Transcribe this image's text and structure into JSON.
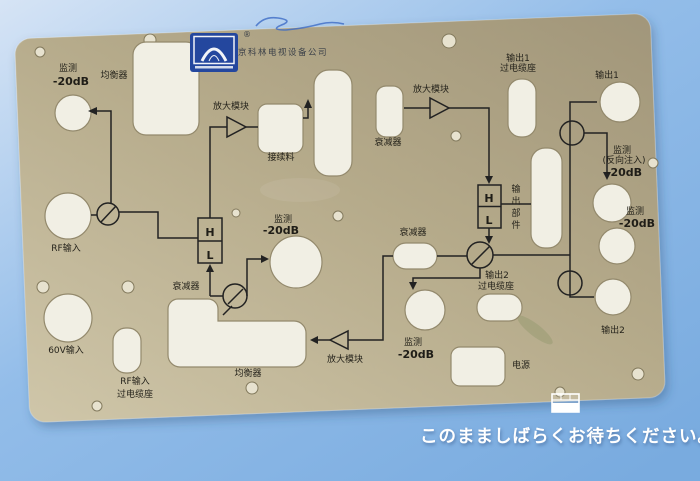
{
  "colors": {
    "background_top": "#d3e2f4",
    "background_bottom": "#7badde",
    "panel": "#b9ae8e",
    "cutout": "#f1efe4",
    "schematic_line": "#222222",
    "logo_blue": "#24479e",
    "message_text": "#ffffff"
  },
  "panel": {
    "company_name": "北京科林电视设备公司",
    "registered_mark": "®",
    "logo": "kelin-arch-logo",
    "labels": {
      "monitor_top_left": {
        "l1": "监测",
        "l2": "-20dB"
      },
      "equalizer_top": "均衡器",
      "amplifier_top": "放大模块",
      "plugin_slot": "接续料",
      "attenuator_top": "衰减器",
      "amplifier_right": "放大模块",
      "output1_socket": {
        "l1": "输出1",
        "l2": "过电缆座"
      },
      "output1": "输出1",
      "monitor_reverse": {
        "l1": "监测",
        "l2": "(反向注入)",
        "l3": "-20dB"
      },
      "monitor_right": {
        "l1": "监测",
        "l2": "-20dB"
      },
      "output_part": {
        "c1": "输",
        "c2": "出",
        "c3": "部",
        "c4": "件"
      },
      "monitor_mid": {
        "l1": "监测",
        "l2": "-20dB"
      },
      "hl_left": {
        "h": "H",
        "l": "L"
      },
      "hl_right": {
        "h": "H",
        "l": "L"
      },
      "attenuator_left": "衰减器",
      "attenuator_mid": "衰减器",
      "output2_socket": {
        "l1": "输出2",
        "l2": "过电缆座"
      },
      "monitor_bottom": {
        "l1": "监测",
        "l2": "-20dB"
      },
      "amplifier_bottom": "放大模块",
      "equalizer_bottom": "均衡器",
      "rf_input": "RF输入",
      "v60_input": "60V输入",
      "rf_socket": {
        "l1": "RF输入",
        "l2": "过电缆座"
      },
      "power": "电源",
      "output2": "输出2"
    }
  },
  "overlay": {
    "wait_message": "このまましばらくお待ちください。"
  }
}
